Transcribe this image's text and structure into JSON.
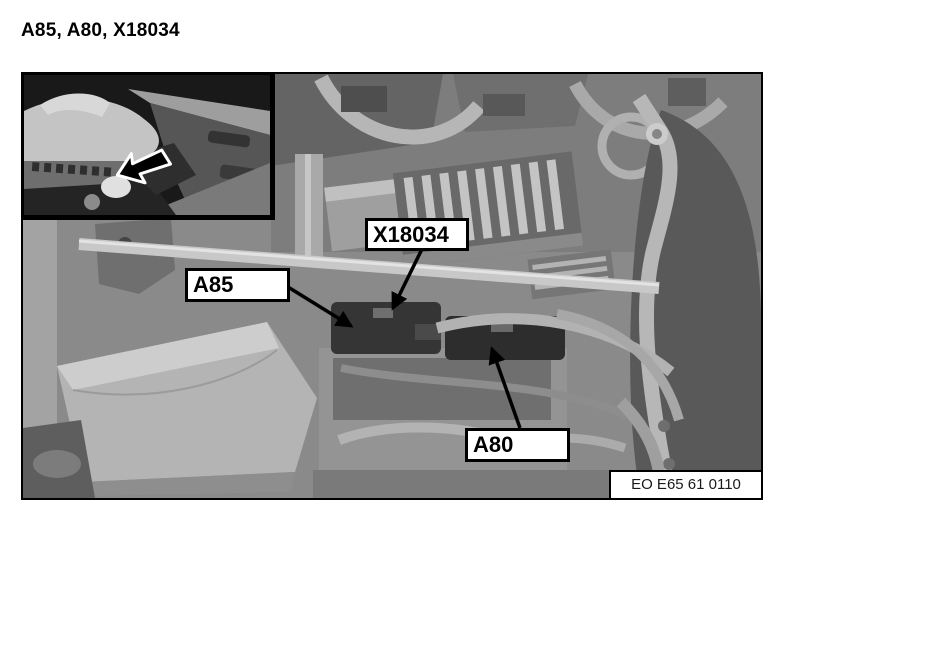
{
  "title": "A85, A80, X18034",
  "figure": {
    "callouts": [
      {
        "label": "X18034"
      },
      {
        "label": "A85"
      },
      {
        "label": "A80"
      }
    ],
    "image_code": "EO E65 61 0110"
  },
  "icons": {
    "inset_arrow": "location-arrow-icon",
    "callout_arrow": "callout-arrow-icon"
  },
  "colors": {
    "page_background": "#ffffff",
    "text": "#000000",
    "callout_box_background": "#ffffff",
    "callout_box_border": "#000000",
    "photo_base_gray": "#8a8a8a",
    "inset_background": "#191919"
  }
}
